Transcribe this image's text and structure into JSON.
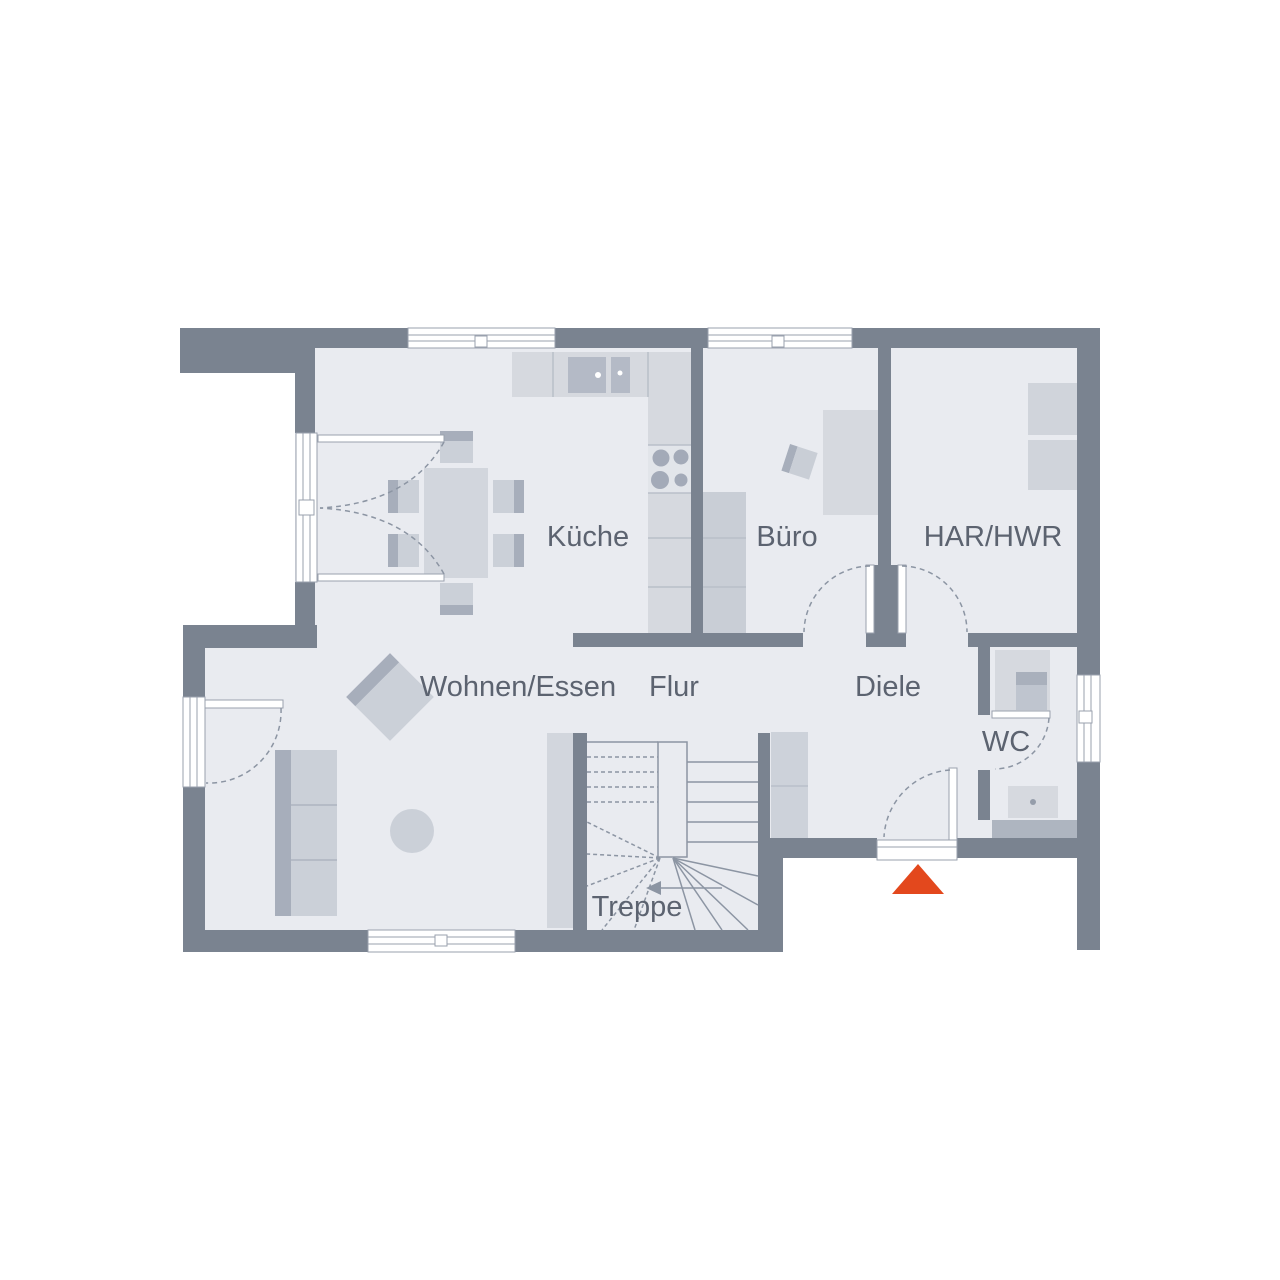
{
  "plan": {
    "type": "floor-plan",
    "floor": "Erdgeschoss"
  },
  "rooms": {
    "kueche": "Küche",
    "buero": "Büro",
    "har_hwr": "HAR/HWR",
    "wohnen_essen": "Wohnen/Essen",
    "flur": "Flur",
    "diele": "Diele",
    "wc": "WC",
    "treppe": "Treppe"
  },
  "colors": {
    "wall": "#7A8390",
    "wall_light": "#AEB5C0",
    "floor": "#E9EBF0",
    "furniture_light": "#D6D9DF",
    "furniture_medium": "#CBD0D8",
    "furniture_dark": "#A7AEBB",
    "label_text": "#5C6370",
    "entrance_marker": "#E3481D",
    "background": "#FFFFFF"
  },
  "entrance_marker": {
    "shape": "triangle-up",
    "color": "#E3481D"
  }
}
